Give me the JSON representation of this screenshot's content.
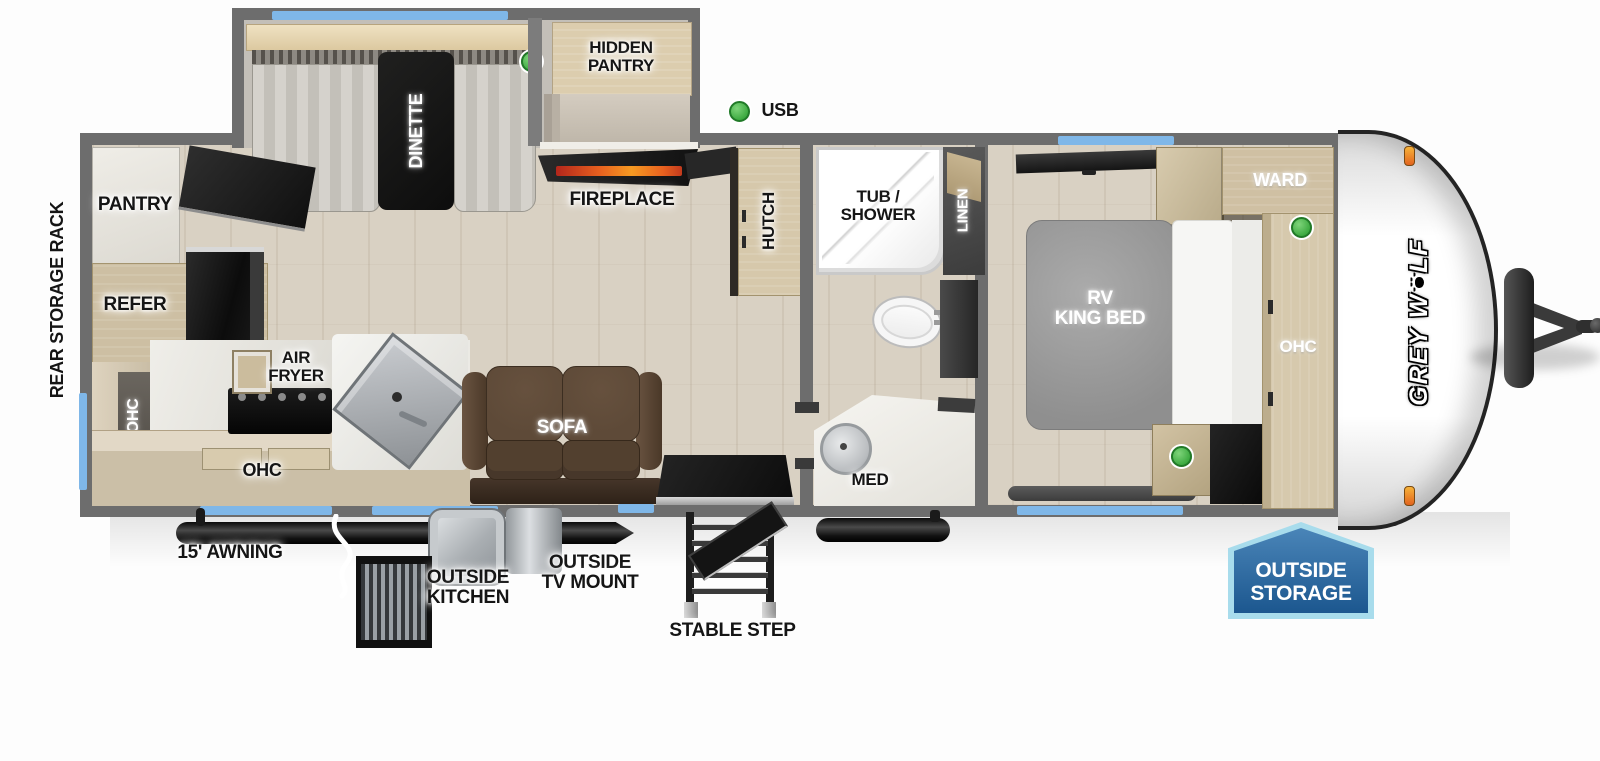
{
  "brand": {
    "part1": "GREY W",
    "part2": "LF"
  },
  "labels": {
    "rear_storage_rack": "REAR STORAGE RACK",
    "pantry": "PANTRY",
    "refer": "REFER",
    "ohc_rear": "OHC",
    "air_fryer": [
      "AIR",
      "FRYER"
    ],
    "ohc_kitchen": "OHC",
    "dinette": "DINETTE",
    "hidden_pantry": [
      "HIDDEN",
      "PANTRY"
    ],
    "fireplace": "FIREPLACE",
    "usb": "USB",
    "sofa": "SOFA",
    "hutch": "HUTCH",
    "tub_shower": [
      "TUB /",
      "SHOWER"
    ],
    "linen": "LINEN",
    "med": "MED",
    "rv_king_bed": [
      "RV",
      "KING BED"
    ],
    "ward": "WARD",
    "ohc_bedroom": "OHC",
    "awning": "15' AWNING",
    "outside_kitchen": [
      "OUTSIDE",
      "KITCHEN"
    ],
    "outside_tv_mount": [
      "OUTSIDE",
      "TV MOUNT"
    ],
    "stable_step": "STABLE STEP",
    "outside_storage": [
      "OUTSIDE",
      "STORAGE"
    ]
  },
  "colors": {
    "wall": "#6d6d6d",
    "floor_wood": "#d9d1c3",
    "cabinet_wood": "#cfc0a4",
    "window_blue": "#7fb7e8",
    "usb_green": "#3aa83e",
    "flame_orange": "#e8611f",
    "sofa_brown": "#5b4536",
    "badge_blue": "#2a6aa5",
    "badge_border": "#a8dcec"
  }
}
